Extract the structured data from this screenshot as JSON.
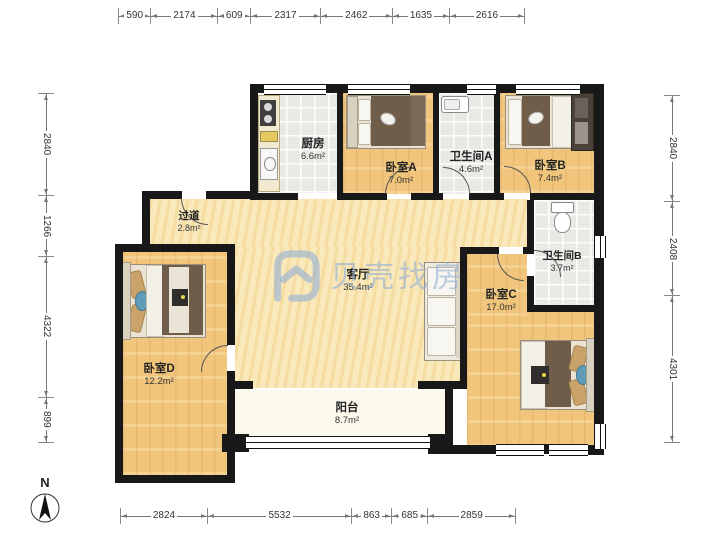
{
  "meta": {
    "watermark": "贝壳找房",
    "compass_label": "N"
  },
  "rooms": [
    {
      "id": "kitchen",
      "name": "厨房",
      "area": "6.6m²"
    },
    {
      "id": "bedroomA",
      "name": "卧室A",
      "area": "7.0m²"
    },
    {
      "id": "bathA",
      "name": "卫生间A",
      "area": "4.6m²"
    },
    {
      "id": "bedroomB",
      "name": "卧室B",
      "area": "7.4m²"
    },
    {
      "id": "hallway",
      "name": "过道",
      "area": "2.8m²"
    },
    {
      "id": "living",
      "name": "客厅",
      "area": "35.4m²"
    },
    {
      "id": "bathB",
      "name": "卫生间B",
      "area": "3.7m²"
    },
    {
      "id": "bedroomC",
      "name": "卧室C",
      "area": "17.0m²"
    },
    {
      "id": "bedroomD",
      "name": "卧室D",
      "area": "12.2m²"
    },
    {
      "id": "balcony",
      "name": "阳台",
      "area": "8.7m²"
    }
  ],
  "dimensions": {
    "top": [
      590,
      2174,
      609,
      2317,
      2462,
      1635,
      2616
    ],
    "bottom": [
      2824,
      5532,
      863,
      685,
      2859
    ],
    "left": [
      2840,
      1266,
      4322,
      899
    ],
    "right": [
      2840,
      2408,
      4301
    ]
  },
  "colors": {
    "wall": "#181818",
    "wood_floor": "#f1c67c",
    "living_floor": "#f8e5b2",
    "tile_floor": "#e9e8e4",
    "balcony_floor": "#fbf9ec",
    "watermark_blue": "#94b1d5"
  }
}
